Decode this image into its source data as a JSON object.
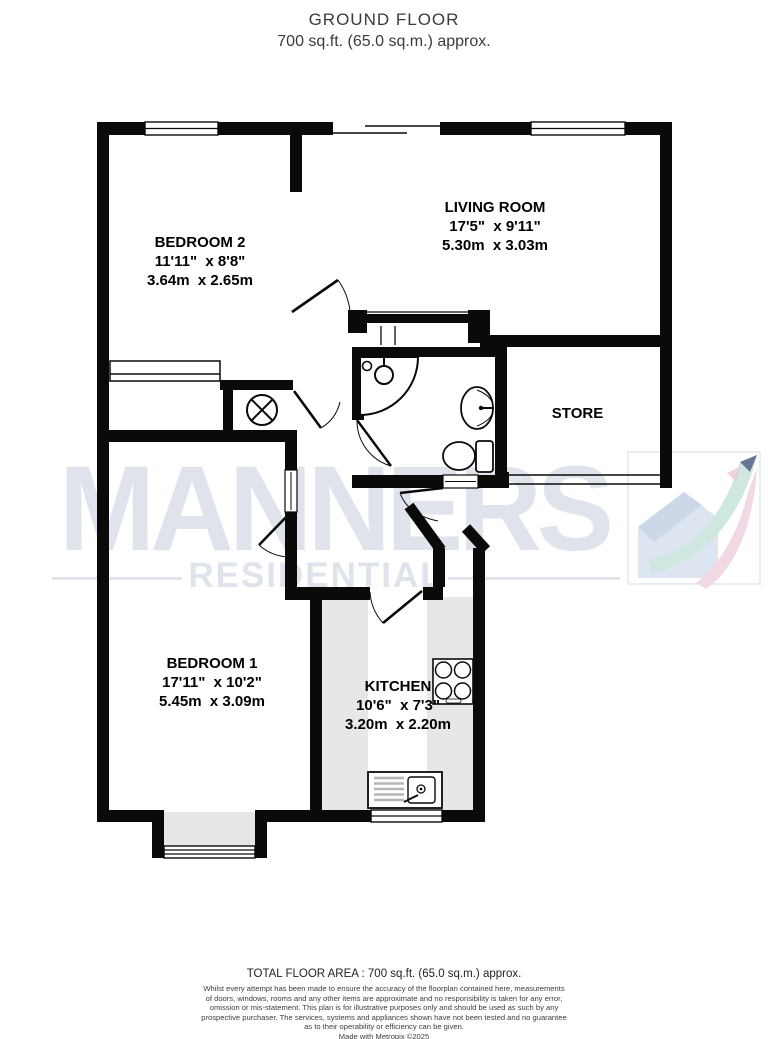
{
  "title": {
    "line1": "GROUND FLOOR",
    "line2": "700 sq.ft. (65.0 sq.m.) approx."
  },
  "rooms": {
    "bedroom2": {
      "name": "BEDROOM 2",
      "imperial": "11'11\"  x 8'8\"",
      "metric": "3.64m  x 2.65m"
    },
    "living_room": {
      "name": "LIVING ROOM",
      "imperial": "17'5\"  x 9'11\"",
      "metric": "5.30m  x 3.03m"
    },
    "store": {
      "name": "STORE"
    },
    "bedroom1": {
      "name": "BEDROOM 1",
      "imperial": "17'11\"  x 10'2\"",
      "metric": "5.45m  x 3.09m"
    },
    "kitchen": {
      "name": "KITCHEN",
      "imperial": "10'6\"  x 7'3\"",
      "metric": "3.20m  x 2.20m"
    }
  },
  "watermark": {
    "brand": "MANNERS",
    "sub": "RESIDENTIAL"
  },
  "footer": {
    "total": "TOTAL FLOOR AREA : 700 sq.ft. (65.0 sq.m.) approx.",
    "disclaimer": [
      "Whilst every attempt has been made to ensure the accuracy of the floorplan contained here, measurements",
      "of doors, windows, rooms and any other items are approximate and no responsibility is taken for any error,",
      "omission or mis-statement. This plan is for illustrative purposes only and should be used as such by any",
      "prospective purchaser. The services, systems and appliances shown have not been tested and no guarantee",
      "as to their operability or efficiency can be given."
    ],
    "credit": "Made with Metropix ©2025"
  },
  "colors": {
    "wall": "#0a0a0a",
    "counter": "#e7e7e7",
    "watermark": "#dfe3eb",
    "logo_teal": "#cfe7e1",
    "logo_pink": "#f1d8e4",
    "logo_house": "#dce5f0",
    "logo_navy": "#2c3a6b"
  }
}
